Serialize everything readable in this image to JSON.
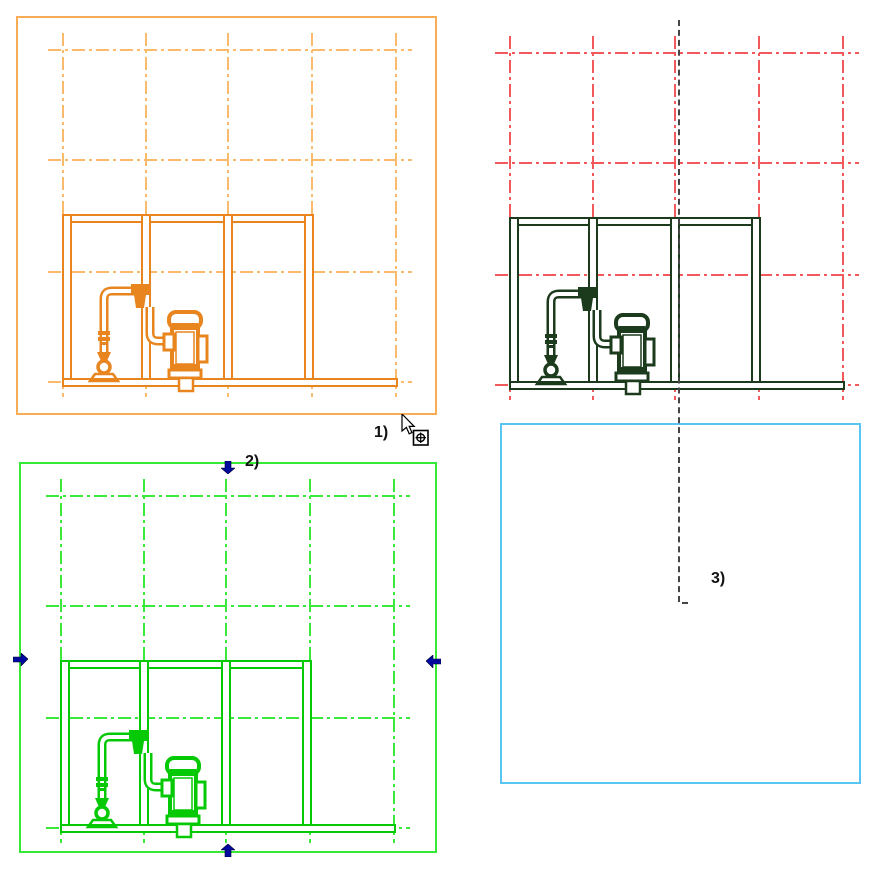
{
  "annotations": {
    "label1": "1)",
    "label2": "2)",
    "label3": "3)"
  },
  "viewports": [
    {
      "name": "viewport-1",
      "label": "1)",
      "border_color": "#F7AC55",
      "grid_color": "#F9BA6B",
      "drawing_color": "#E8851E",
      "state": "default"
    },
    {
      "name": "viewport-2",
      "label": "2)",
      "border_color": "none",
      "grid_color": "#F2595B",
      "drawing_color": "#1C3A1C",
      "state": "no-crop-border"
    },
    {
      "name": "viewport-3",
      "label": "2)",
      "border_color": "#35E935",
      "grid_color": "#3BE93B",
      "drawing_color": "#05C905",
      "state": "selected",
      "selection_handles": [
        "top",
        "left",
        "right",
        "bottom"
      ]
    },
    {
      "name": "viewport-4",
      "label": "3)",
      "border_color": "#59C5F3",
      "grid_color": "none",
      "drawing_color": "none",
      "state": "empty"
    }
  ],
  "colors": {
    "selection_handle": "#000A9E",
    "reference_dashed_line": "#454545",
    "background": "#FFFFFF"
  },
  "cursor": {
    "type": "arrow-pointer-with-zoom-region-badge"
  }
}
